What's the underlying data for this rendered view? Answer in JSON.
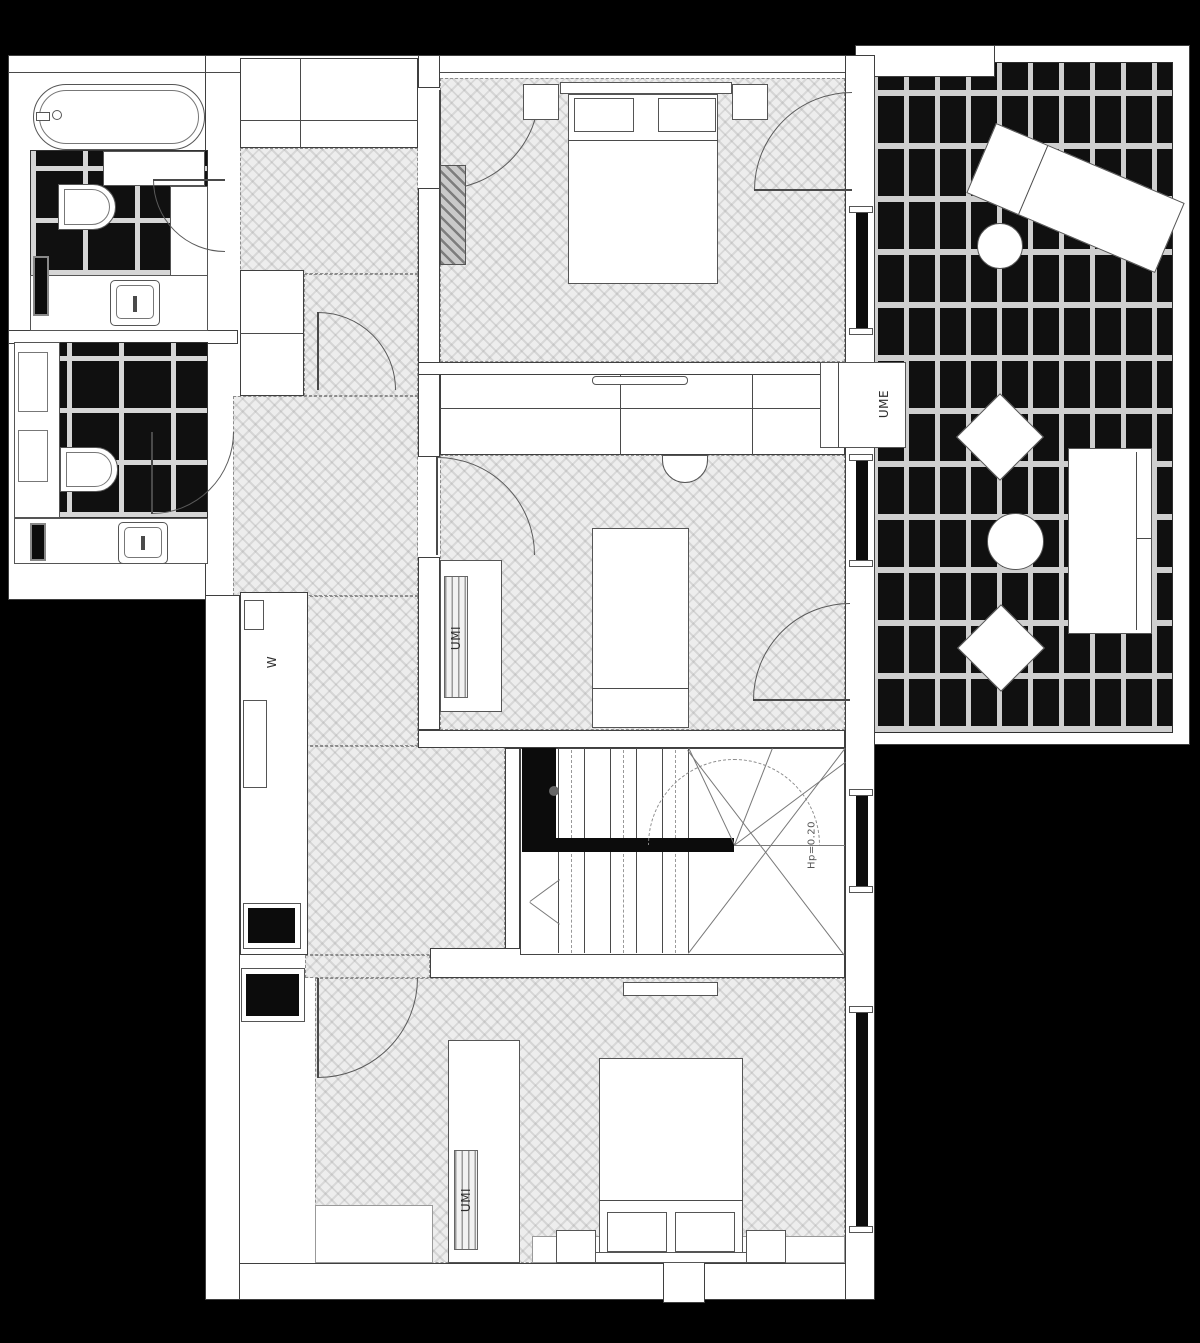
{
  "labels": {
    "hall_closet": "W",
    "bedroom2_wardrobe": "UMI",
    "bedroom3_wardrobe": "UMI",
    "terrace_closet": "UME",
    "stair_note": "Hp=0.20"
  },
  "colors": {
    "background": "#000000",
    "walls": "#ffffff",
    "lines": "#3f3f3f",
    "parquet_floor": "#ededed",
    "tile_dark": "#101010",
    "tile_grout": "#d6d6d6"
  },
  "furniture_icons": [
    "bathtub-icon",
    "toilet-icon",
    "washbasin-icon",
    "radiator-icon",
    "double-bed-icon",
    "single-bed-icon",
    "wardrobe-icon",
    "tv-icon",
    "desk-chair-icon",
    "staircase-icon",
    "sun-lounger-icon",
    "round-table-icon",
    "lounge-chair-icon",
    "outdoor-sofa-icon",
    "shelf-icon"
  ]
}
